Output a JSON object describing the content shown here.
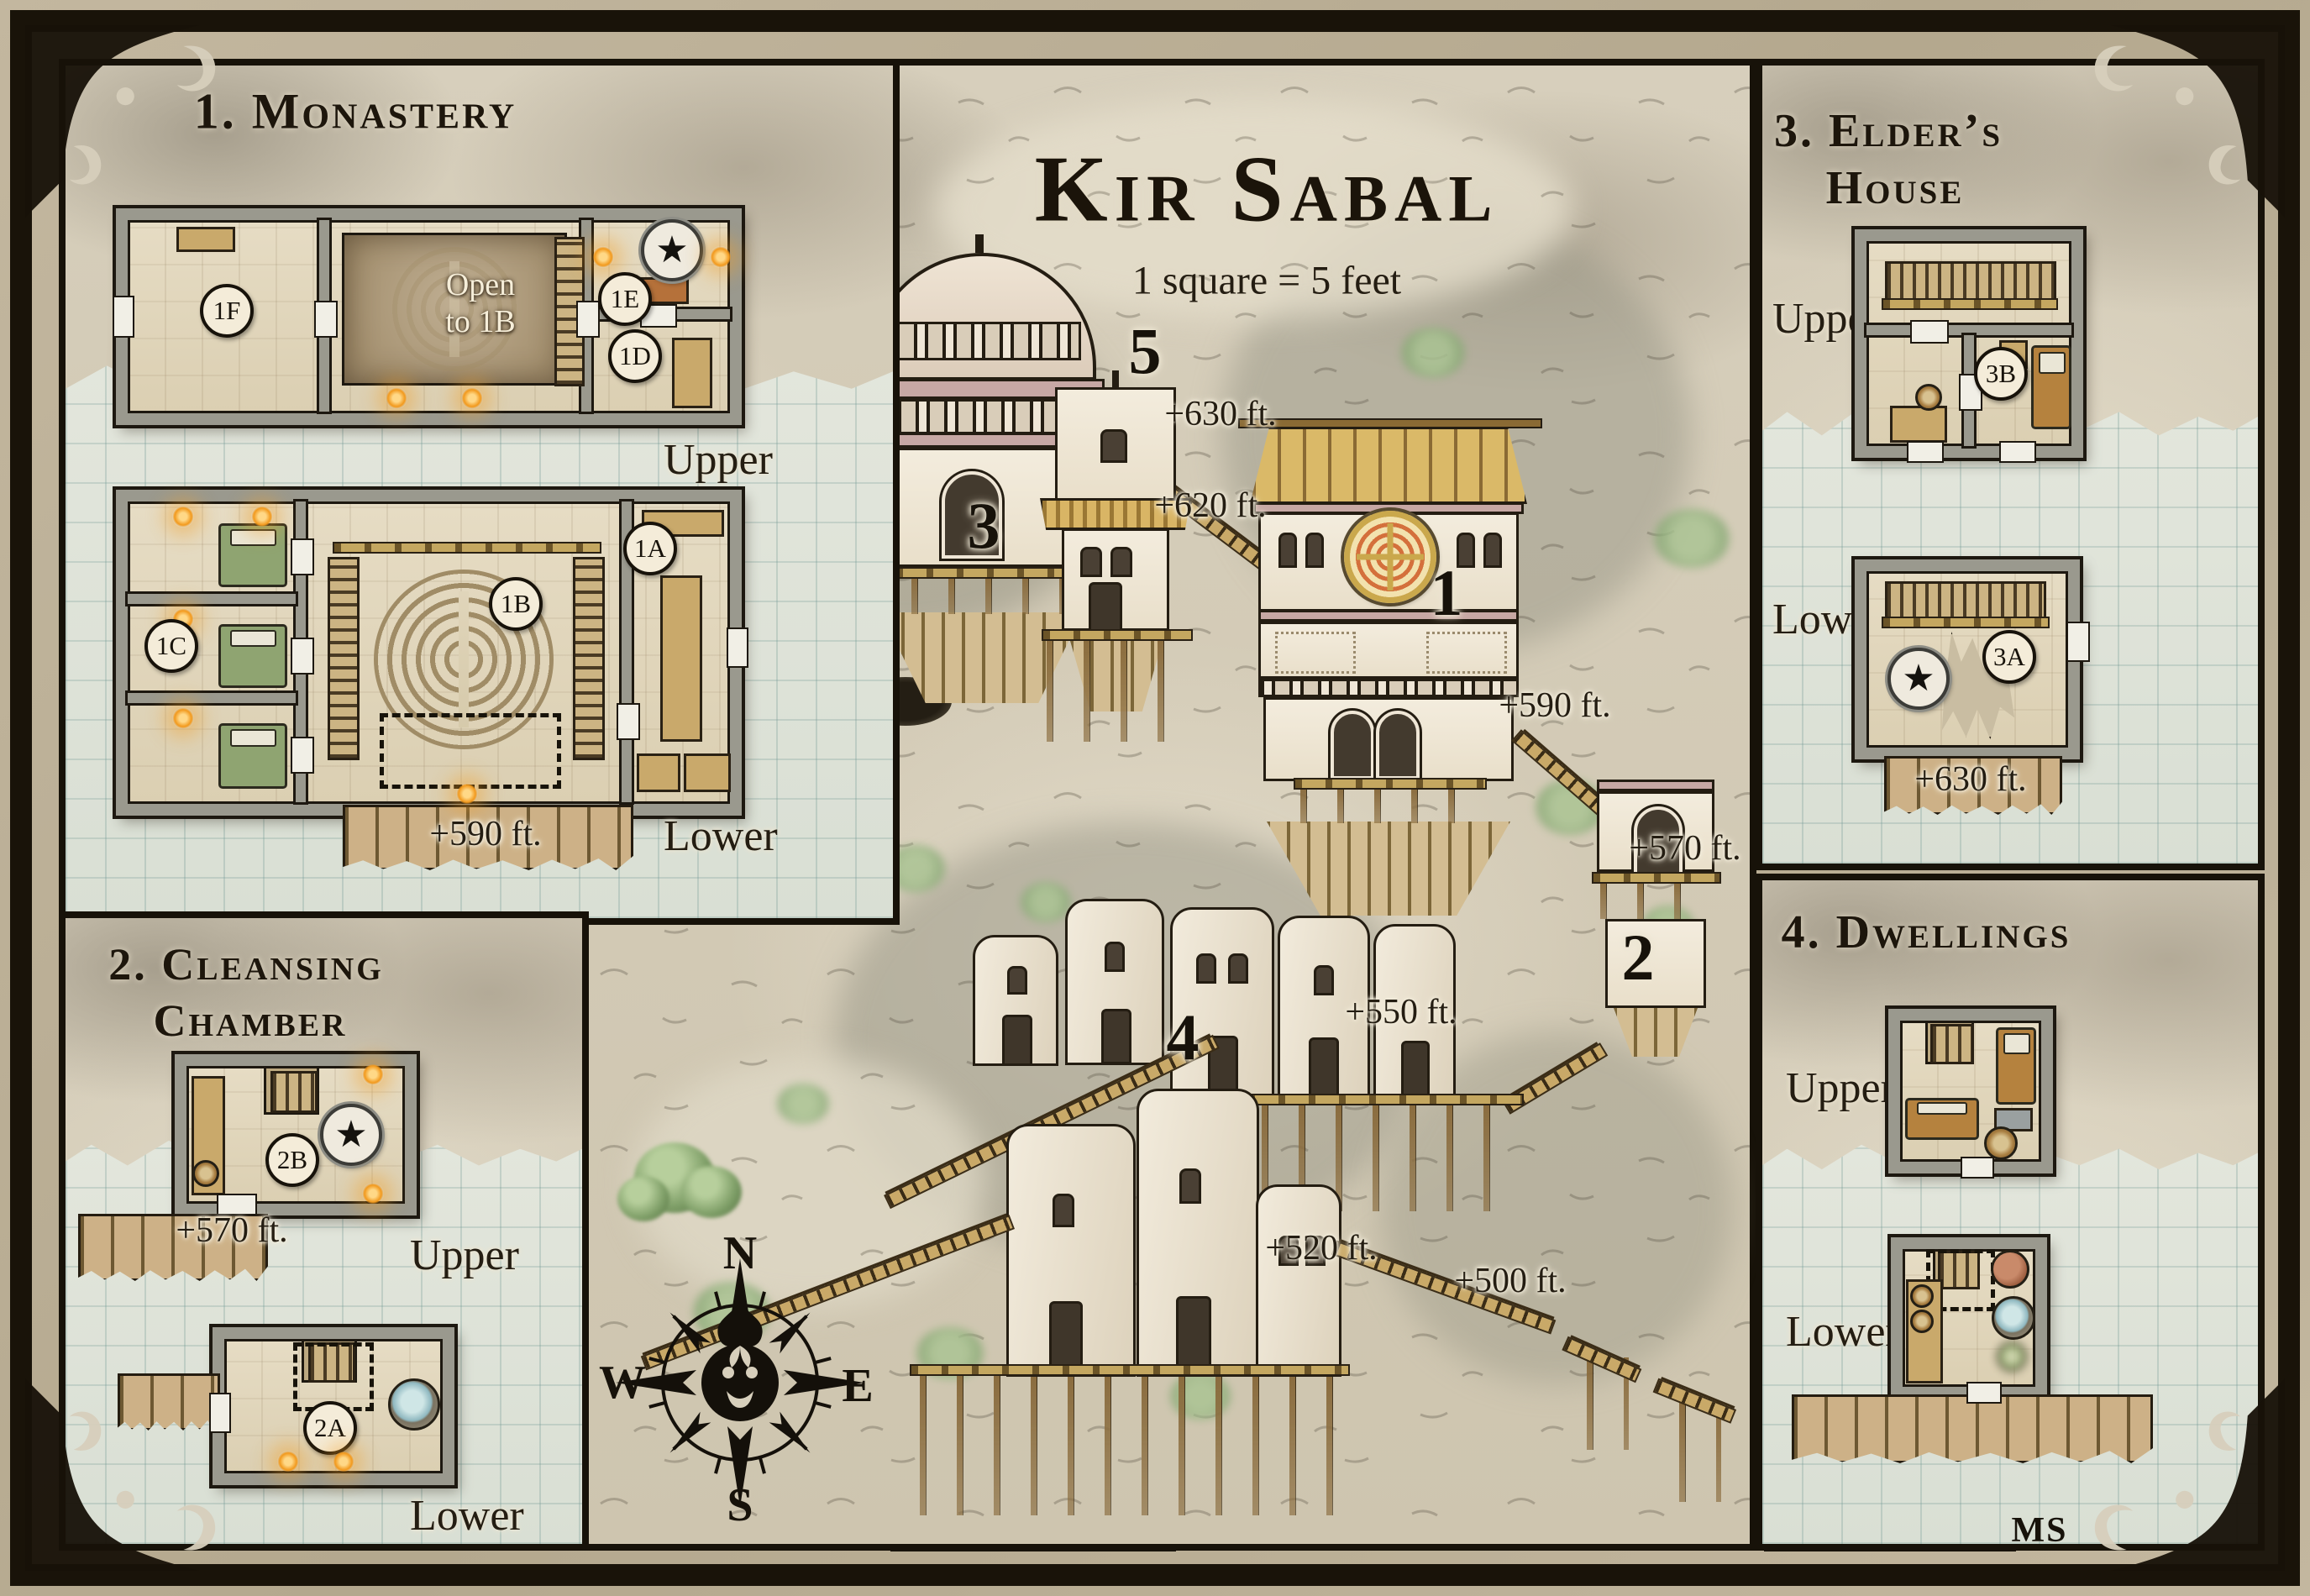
{
  "map": {
    "title": "Kir Sabal",
    "scale_note": "1 square = 5 feet",
    "signature": "MS",
    "compass": {
      "north": "N",
      "south": "S",
      "east": "E",
      "west": "W"
    },
    "markers": {
      "m1": "1",
      "m2": "2",
      "m3": "3",
      "m4": "4",
      "m5": "5"
    },
    "elevations": {
      "e630": "+630 ft.",
      "e620": "+620 ft.",
      "e590": "+590 ft.",
      "e570": "+570 ft.",
      "e550": "+550 ft.",
      "e520": "+520 ft.",
      "e500": "+500 ft."
    },
    "colors": {
      "parchment": "#d7cfbc",
      "ink": "#17120a",
      "torch_orange": "#f2991c",
      "grid_blue": "#a8c2bc",
      "roof_wood": "#dab968",
      "emblem_orange": "#d4703c"
    }
  },
  "panels": {
    "monastery": {
      "title": "1. Monastery",
      "upper_label": "Upper",
      "lower_label": "Lower",
      "room_1f": "1F",
      "room_1e": "1E",
      "room_1d": "1D",
      "room_1c": "1C",
      "room_1b": "1B",
      "room_1a": "1A",
      "open_note_line1": "Open",
      "open_note_line2": "to 1B",
      "elevation": "+590 ft."
    },
    "cleansing": {
      "title_line1": "2. Cleansing",
      "title_line2": "Chamber",
      "upper_label": "Upper",
      "lower_label": "Lower",
      "room_2b": "2B",
      "room_2a": "2A",
      "elevation": "+570 ft."
    },
    "elders": {
      "title_line1": "3. Elder’s",
      "title_line2": "House",
      "upper_label": "Upper",
      "lower_label": "Lower",
      "room_3b": "3B",
      "room_3a": "3A",
      "elevation": "+630 ft."
    },
    "dwellings": {
      "title": "4. Dwellings",
      "upper_label": "Upper",
      "lower_label": "Lower"
    }
  }
}
